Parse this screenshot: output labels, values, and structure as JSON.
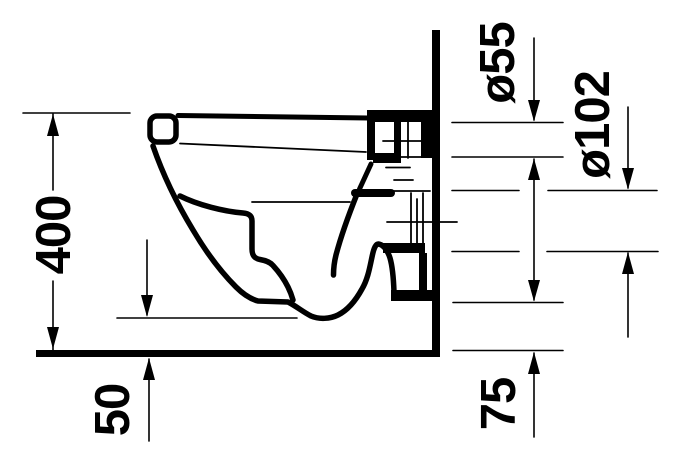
{
  "drawing": {
    "background_color": "#ffffff",
    "line_color": "#000000",
    "view": "wall-hung toilet side elevation",
    "dimension_labels": {
      "overall_height": "400",
      "bottom_clearance": "50",
      "flush_pipe_diameter": "ø55",
      "outlet_pipe_diameter": "ø102",
      "outlet_to_floor": "75"
    }
  }
}
